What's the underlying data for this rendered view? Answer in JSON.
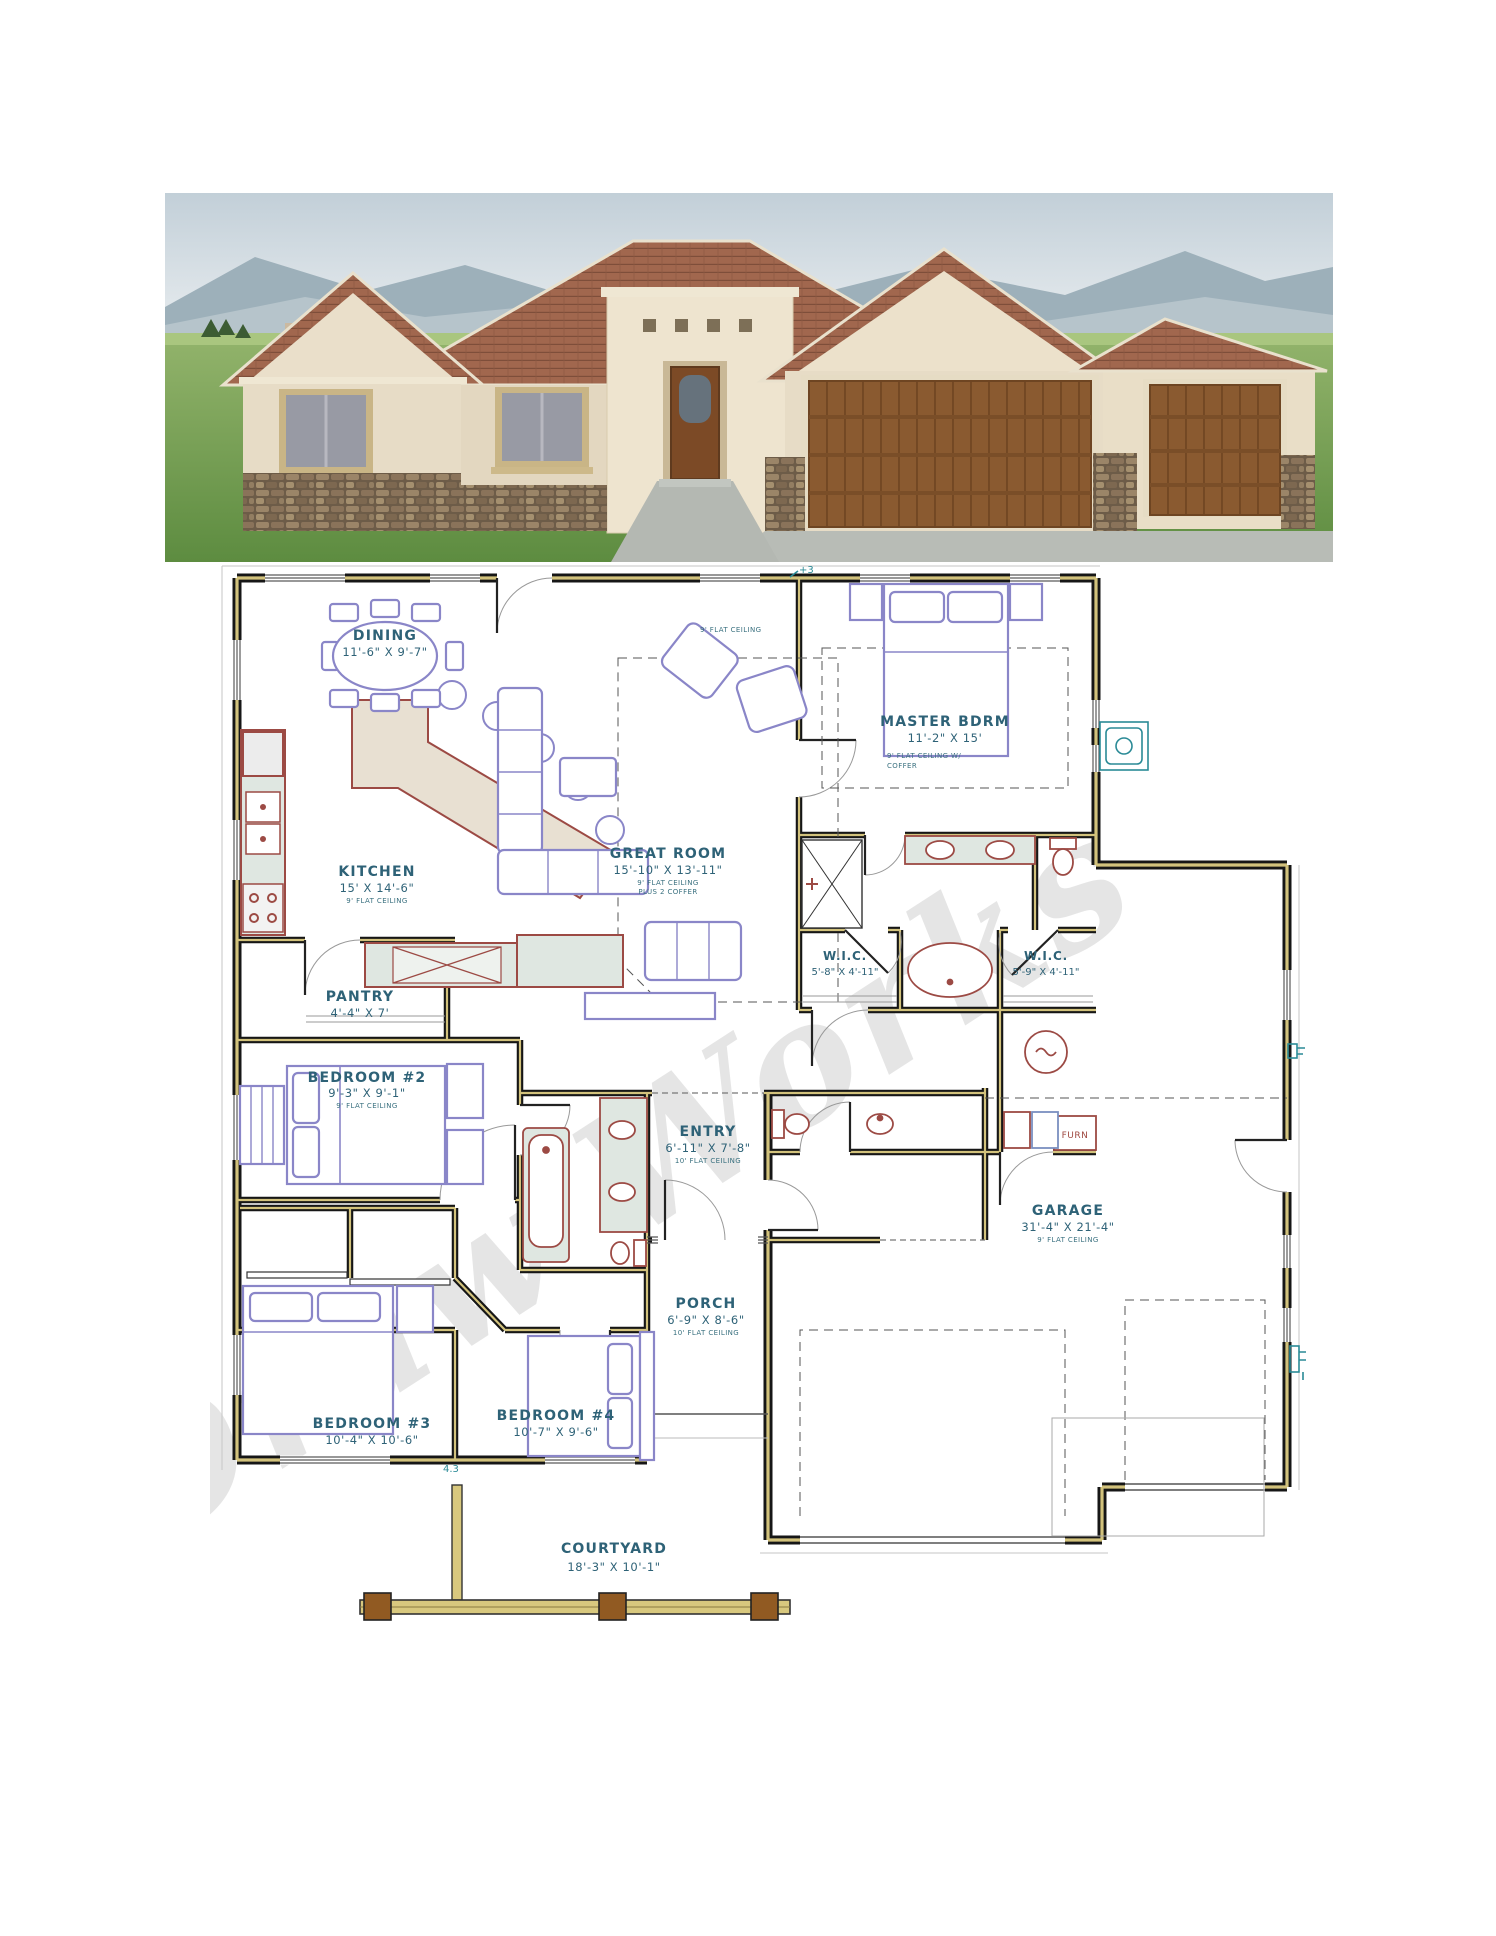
{
  "watermark": {
    "text": "Draw Works"
  },
  "colors": {
    "label_teal": "#2e6277",
    "fixture_red": "#9c4a44",
    "furniture_purple": "#8a86c8",
    "wall_core_tan": "#d2c27c",
    "utility_teal": "#2a8a96",
    "roof_tile": "#a1674e",
    "stucco": "#e8ddc7",
    "garage_door_brown": "#8a5a30"
  },
  "plan": {
    "misc": {
      "furn": "FURN",
      "top_ceiling": "9' FLAT CEILING",
      "elev_top": "+3",
      "elev_bottom": "4.3"
    },
    "rooms": [
      {
        "id": "dining",
        "name": "DINING",
        "dims": "11'-6\" X 9'-7\""
      },
      {
        "id": "kitchen",
        "name": "KITCHEN",
        "dims": "15' X 14'-6\"",
        "note": "9' FLAT CEILING"
      },
      {
        "id": "great",
        "name": "GREAT ROOM",
        "dims": "15'-10\" X 13'-11\"",
        "note": "9' FLAT CEILING",
        "note2": "PLUS 2 COFFER"
      },
      {
        "id": "master",
        "name": "MASTER BDRM",
        "dims": "11'-2\" X 15'",
        "note": "9' FLAT CEILING W/",
        "note2": "COFFER"
      },
      {
        "id": "wic-left",
        "name": "W.I.C.",
        "dims": "5'-8\" X 4'-11\""
      },
      {
        "id": "wic-right",
        "name": "W.I.C.",
        "dims": "5'-9\" X 4'-11\""
      },
      {
        "id": "pantry",
        "name": "PANTRY",
        "dims": "4'-4\" X 7'"
      },
      {
        "id": "bedroom2",
        "name": "BEDROOM #2",
        "dims": "9'-3\" X 9'-1\"",
        "note": "9' FLAT CEILING"
      },
      {
        "id": "entry",
        "name": "ENTRY",
        "dims": "6'-11\" X 7'-8\"",
        "note": "10' FLAT CEILING"
      },
      {
        "id": "garage",
        "name": "GARAGE",
        "dims": "31'-4\" X 21'-4\"",
        "note": "9' FLAT CEILING"
      },
      {
        "id": "porch",
        "name": "PORCH",
        "dims": "6'-9\" X 8'-6\"",
        "note": "10' FLAT CEILING"
      },
      {
        "id": "bedroom3",
        "name": "BEDROOM #3",
        "dims": "10'-4\" X 10'-6\""
      },
      {
        "id": "bedroom4",
        "name": "BEDROOM #4",
        "dims": "10'-7\" X 9'-6\""
      },
      {
        "id": "courtyard",
        "name": "COURTYARD",
        "dims": "18'-3\" X 10'-1\""
      }
    ]
  }
}
